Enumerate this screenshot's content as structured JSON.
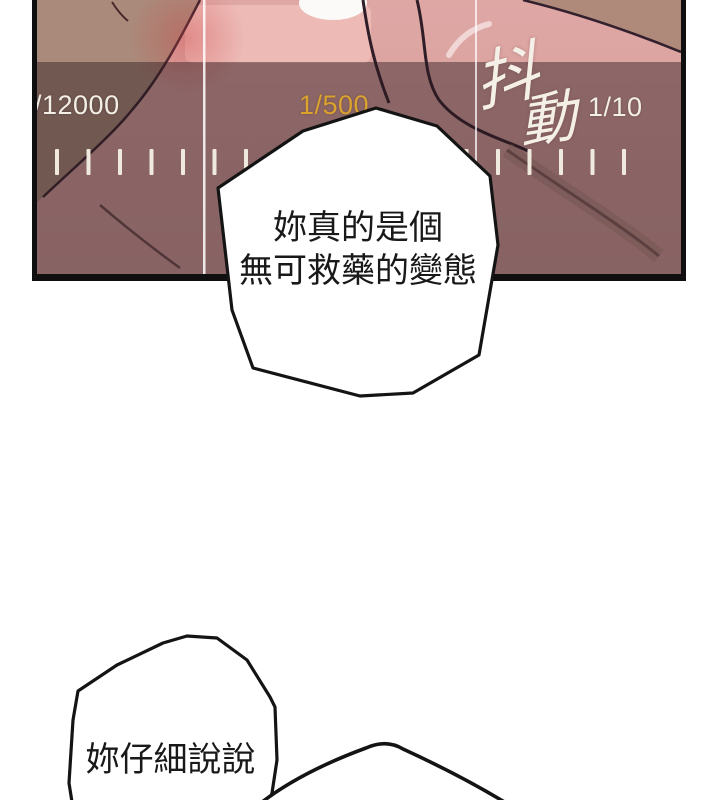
{
  "viewfinder": {
    "shake_warning": {
      "char1": "抖",
      "char2": "動"
    },
    "scale": {
      "left_label": "/12000",
      "center_label": "1/500",
      "right_label": "1/10",
      "selected_color": "#dba22d",
      "label_color": "#f3efe7",
      "ticks_count": 19
    },
    "colors": {
      "border": "#0f0f0f",
      "skin_pink": "#d9a3a1",
      "skin_tan": "#aa8a7b",
      "overlay": "rgba(44,27,31,0.45)"
    }
  },
  "bubbles": [
    {
      "lines": [
        "妳真的是個",
        "無可救藥的變態"
      ]
    },
    {
      "lines": [
        "妳仔細說說"
      ]
    },
    {
      "lines": []
    }
  ]
}
